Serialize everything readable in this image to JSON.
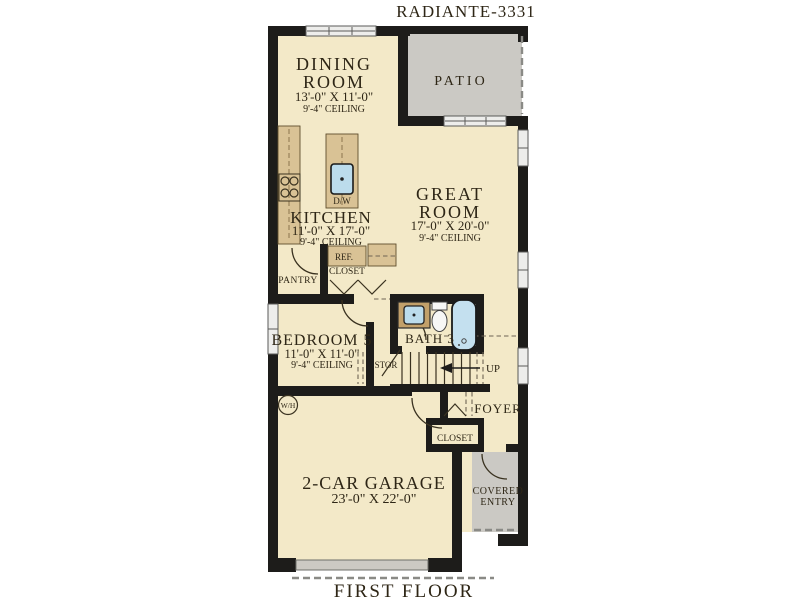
{
  "header": {
    "title": "RADIANTE-3331"
  },
  "footer": {
    "label": "FIRST FLOOR"
  },
  "rooms": {
    "dining": {
      "line1": "DINING",
      "line2": "ROOM",
      "dims": "13'-0\" X 11'-0\"",
      "ceiling": "9'-4\" CEILING"
    },
    "patio": {
      "name": "PATIO"
    },
    "great": {
      "line1": "GREAT",
      "line2": "ROOM",
      "dims": "17'-0\" X 20'-0\"",
      "ceiling": "9'-4\" CEILING"
    },
    "kitchen": {
      "name": "KITCHEN",
      "dims": "11'-0\" X 17'-0\"",
      "ceiling": "9'-4\" CEILING"
    },
    "bedroom5": {
      "name": "BEDROOM 5",
      "dims": "11'-0\" X 11'-0\"",
      "ceiling": "9'-4\" CEILING"
    },
    "bath3": {
      "name": "BATH 3"
    },
    "foyer": {
      "name": "FOYER"
    },
    "garage": {
      "name": "2-CAR GARAGE",
      "dims": "23'-0\" X 22'-0\""
    },
    "covered_entry": {
      "line1": "COVERED",
      "line2": "ENTRY"
    }
  },
  "features": {
    "pantry": "PANTRY",
    "refrigerator": "REF.",
    "kitchen_closet": "CLOSET",
    "dishwasher": "D/W",
    "storage": "STOR",
    "stairs": "UP",
    "foyer_closet": "CLOSET",
    "water_heater": "W/H"
  },
  "colors": {
    "floor": "#f3e9c8",
    "outdoor": "#cbc9c4",
    "wall": "#1d1c1a",
    "cabinet": "#d9c295",
    "plumbing": "#bcdcec",
    "label_text": "#2e2616"
  }
}
